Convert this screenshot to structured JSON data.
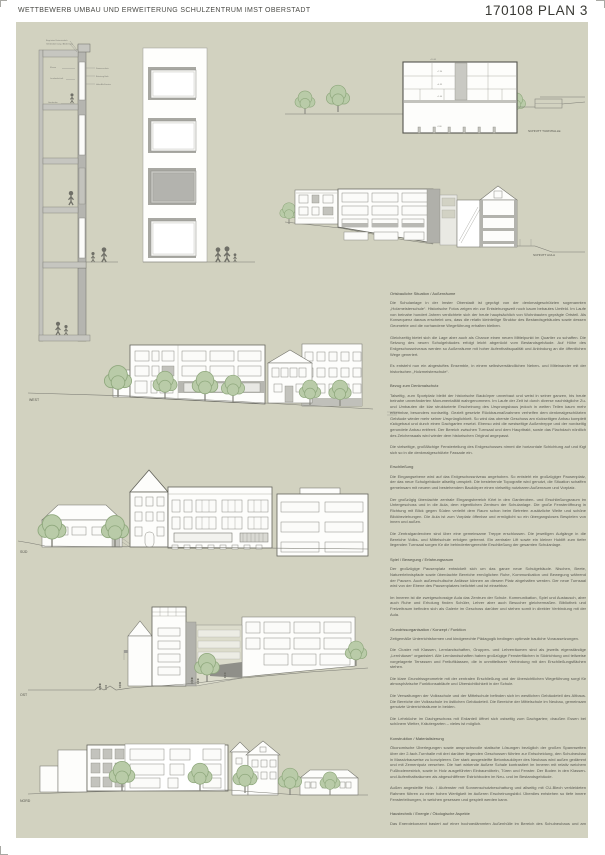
{
  "header": {
    "title": "WETTBEWERB UMBAU UND ERWEITERUNG SCHULZENTRUM IMST OBERSTADT",
    "plan_number": "170108 PLAN 3"
  },
  "colors": {
    "panel_background": "#d2d2c0",
    "drawing_line": "#63635b",
    "poche_gray": "#b3b3ad",
    "tree_green": "#b9cba8"
  },
  "drawings": {
    "wall_section": {
      "annotations_top": [
        "Begrüntes Extensivdach",
        "Gefälledämmung / Abdichtung"
      ],
      "annotations_left": [
        "Klasse",
        "Lernlandschaft",
        "Garderobe"
      ],
      "annotations_right": [
        "Sonnenschutz",
        "Brüstung Holz",
        "Holz-Alu-Fenster"
      ]
    },
    "schnitt_turnhalle": {
      "label": "SCHNITT TURNHALLE",
      "levels": [
        "+10.45",
        "+7.30",
        "+4.35",
        "+1.40",
        "-2.80"
      ]
    },
    "schnitt_aula": {
      "label": "SCHNITT AULA"
    },
    "elevation_west": {
      "label": "WEST"
    },
    "elevation_sued": {
      "label": "SÜD"
    },
    "elevation_ost": {
      "label": "OST"
    },
    "elevation_nord": {
      "label": "NORD"
    }
  },
  "text_column": {
    "sections": [
      {
        "heading": "Ortsbauliche Situation / Außenräume",
        "paragraphs": [
          "Die Schulanlage in der Imster Oberstadt ist geprägt von der denkmalgeschützten sogenannten „Holzmeisterschule“. Historische Fotos zeigen ein zur Entstehungszeit noch kaum bebautes Umfeld. Im Laufe von beinahe hundert Jahren verdichtete sich der heute hauptsächlich von Wohnbauten geprägte Ortsteil. Als Konsequenz daraus erscheint uns, dass die relativ kleinteilige Struktur des Bestandsgebäudes sowie dessen Geometrie und die vorhandene Wegeführung erhalten bleiben.",
          "Gleichzeitig bietet sich die Lage aber auch als Chance einen neuen Mittelpunkt im Quartier zu schaffen. Die Setzung des neuen Schulgebäudes erfolgt leicht abgerückt vom Bestandsgebäude. Auf Höhe des Erdgeschossniveaus werden so Außenräume mit hoher Aufenthaltsqualität und Anbindung an die öffentlichen Wege generiert.",
          "Es entsteht nun ein abgestuftes Ensemble, in einem selbstverständlichen Neben- und Miteinander mit der historischen „Holzmeisterschule“."
        ]
      },
      {
        "heading": "Bezug zum Denkmalschutz",
        "paragraphs": [
          "Talseitig, zum Sportplatz bleibt der historische Baukörper unverbaut und weist in seiner ganzen, bis heute beinahe unveränderten Monumentalität wahrgenommen. Im Laufe der Zeit ist durch diverse nachträgliche Zu- und Umbauten die klar strukturierte Erscheinung des Ursprungsbaus jedoch in weiten Teilen kaum mehr erkennbar, besonders nordseitig. Gezielt gesetzte Rückbaumaßnahmen verhelfen dem denkmalgeschützten Gebäude wieder mehr seiner Ursprünglichkeit. So wird das oberste Geschoss am rückseitigen Anbau komplett rückgebaut und durch einen Dachgarten ersetzt. Ebenso wird die westseitige Außentreppe und der nordseitig gerundete Anbau entfernt. Der Bereich zwischen Turnsaal und dem Haupttrakt, sowie das Flachdach nördlich des Zeichensaals wird wieder dem historischen Original angepasst.",
          "Die vielseitige, großflächige Fensterteilung des Erdgeschosses nimmt die horizontale Schichtung auf und fügt sich so in die denkmalgeschützte Fassade ein."
        ]
      },
      {
        "heading": "Erschließung",
        "paragraphs": [
          "Die Eingangsebene wird auf das Erdgeschossniveau angehoben. So entsteht ein großzügiger Pausenplatz, der das neue Schulgebäude allseitig umspielt. Die bestehende Topografie wird genutzt, die Situation schaffen gemeinsam mit neuem und bestehendem Baukörper einen vielseitig nutzbaren Außenraum und Vorplatz.",
          "Der großzügig überdachte zentrale Eingangsbereich führt in den Garderoben- und Erschließungsraum im Untergeschoss und in die Aula, dem eigentlichen Zentrum der Schulanlage. Die große Fensteröffnung in Richtung mit Blick gegen Süden verleiht dem Raum schon beim Betreten zusätzliche Weite und schöne Blickbeziehungen. Die Aula ist zum Vorplatz öffenbar und ermöglicht so ein übergangsloses Bespielen von innen und außen.",
          "Die Zentralgarderoben sind über eine gemeinsame Treppe erschlossen. Die jeweiligen Aufgänge in die Bereiche Volks- und Mittelschule erfolgen getrennt. Ein zentraler Lift sowie ein kleiner Hublift zum tiefer liegenden Turnsaal sorgen für die behindertengerechte Erschließung der gesamten Schulanlage."
        ]
      },
      {
        "heading": "Spiel / Bewegung / Erfahrungsraum",
        "paragraphs": [
          "Der großzügige Pausenplatz entwickelt sich um das ganze neue Schulgebäude. Nischen, Beete, Naturerlebnispfade sowie überdachte Bereiche ermöglichen Ruhe, Kommunikation und Bewegung während der Pausen. Auch außerschulische Anlässe können an diesem Platz abgehalten werden. Der neue Turnsaal wird von der Ebene des Pausenplatzes belichtet und ist einsehbar.",
          "Im Inneren ist die zweigeschossige Aula das Zentrum der Schule. Kommunikation, Spiel und Austausch, aber auch Ruhe und Erholung finden Schüler, Lehrer aber auch Besucher gleichermaßen. Bibliothek und Freizeitraum befinden sich als Galerie im Geschoss darüber und stehen somit in direkter Verbindung mit der Aula."
        ]
      },
      {
        "heading": "Grundrissorganisation / Konzept / Funktion",
        "paragraphs": [
          "Zeitgemäße Unterrichtsformen und kindgerechte Pädagogik bedingen optimale bauliche Voraussetzungen.",
          "Die Cluster mit Klassen, Lernlandschaften, Gruppen- und Lehrerräumen sind als jeweils eigenständige „Lernhäuser“ organisiert. Alle Lernlandschaften haben großzügige Fensterflächen in Südrichtung und teilweise vorgelagerte Terrassen und Freiluftklassen, die in unmittelbarer Verbindung mit den Erschließungsflächen stehen.",
          "Die klare Grundrissgeometrie mit der zentralen Erschließung und der übersichtlichen Wegeführung sorgt für atmosphärische Funktionsabläufe und Übersichtlichkeit in der Schule.",
          "Die Verwaltungen der Volksschule und der Mittelschule befinden sich im westlichen Gebäudeteil des Altbaus. Die Bereiche der Volksschule im östlichen Gebäudeteil. Die Bereiche der Mittelschule im Neubau, gemeinsam genutzte Unterrichtsräume in beiden.",
          "Die Lehrküche im Dachgeschoss mit Erdanteil öffnet sich ostseitig zum Dachgarten; draußen Essen bei schönem Wetter, Kräutergarten – vieles ist möglich."
        ]
      },
      {
        "heading": "Konstruktion / Materialisierung",
        "paragraphs": [
          "Ökonomische Überlegungen sowie anspruchsvolle statische Lösungen bezüglich der großen Spannweiten über der 2-fach-Turnhalle mit drei darüber liegenden Geschossen führten zur Entscheidung, den Schulneubau in Massivbauweise zu konzipieren. Der stark ausgesteifte Betonbaukörper des Neubaus wird außen gedämmt und mit Zementputz versehen. Die hart wirkende äußere Schale kontrastiert im Inneren mit relativ weichem Fußbodenestrich, sowie in Holz ausgeführten Einbaumöbeln, Türen und Fenster. Der Boden in den Klassen- und Aufenthaltsräumen als abgeschliffener Estrichboden im Neu- und im Bestandsgebäude.",
          "Außen angestellte Holz- / Alufenster mit Sonnenschutzbeschattung und allseitig mit CU-Blech verkleideten Rahmen führen zu einer hohen Wertigkeit im äußeren Erscheinungsbild. Überdies entstehen so tiefe innere Fensterleibungen, in welchen gesessen und gespielt werden kann."
        ]
      },
      {
        "heading": "Haustechnik / Energie / Ökologische Aspekte",
        "paragraphs": [
          "Das Energiekonzept basiert auf einer hochgedämmten Außenhülle im Bereich des Schulneubaus und am bestehenden unsanierten Gebäudetrakt. Die Kompaktheit des Schulneubaus sorgt zusammen mit der kontrollierten Be- und Entlüftung für eine gute Energiebilanz. Hinsichtlich Materialisierung werden baubiologisch und bauökologisch hochwertige Materialien wie Holz, natürliche Verputze und ggf. verwendet. Wartungsarme Putzfassaden, konstruktiv sonnengeschützte Fenster tragen weiters zu einem nachhaltigen Betrieb der Schule bei.",
          "Am denkmalgeschützten Gebäude selbst ist eine Außendämmung nicht möglich und eine Innendämmung nicht sinnvoll. Im Dachgeschoss ist die thermische Sanierung des Dachbaus angedacht. Das bestehende massive Mauerwerk als Wasserspeicher trägt zu einem guten Raumklima und Energieeffizienz bei. Zur Energiegewinnung wäre eine Photovoltaikanlage am bestehenden Dach empfehlenswert, in Absprache mit dem Denkmalamt."
        ]
      }
    ]
  }
}
